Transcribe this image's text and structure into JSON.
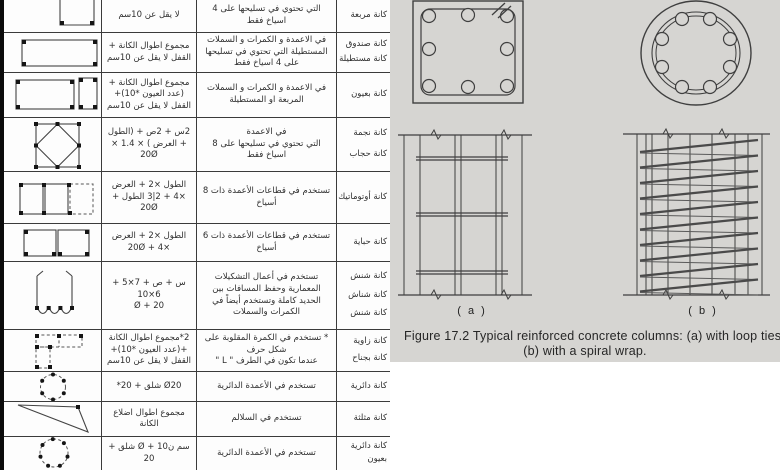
{
  "colors": {
    "figure_panel_bg": "#d6d5d2",
    "drawing_line": "#3f3f3f",
    "table_line": "#3b3b3b"
  },
  "table": {
    "rows": [
      {
        "name_lines": [
          "كانة مربعة"
        ],
        "usage": "التي تحتوي في تسليحها على 4 اسياخ فقط",
        "formula": "لا يقل عن 10سم",
        "shape_icon": "square-stirrup-icon"
      },
      {
        "name_lines": [
          "كانة صندوق",
          "كانة مستطيلة"
        ],
        "usage": "في الاعمدة و الكمرات و السملات المستطيلة التي تحتوي في تسليحها على 4 اسياخ فقط",
        "formula": "مجموع اطوال الكانة + القفل لا يقل عن 10سم",
        "shape_icon": "rect-stirrup-icon"
      },
      {
        "name_lines": [
          "كانة بعيون"
        ],
        "usage": "في الاعمدة و الكمرات و السملات المربعة او المستطيلة",
        "formula": "مجموع اطوال الكانة +(عدد العيون *10)+ القفل لا يقل عن 10سم",
        "shape_icon": "eyed-stirrup-icon"
      },
      {
        "name_lines": [
          "كانة نجمة",
          "كانة حجاب"
        ],
        "usage": "في الاعمدة\nالتي تحتوي في تسليحها على 8 اسياخ فقط",
        "formula": "2س + 2ص + (الطول + العرض ) × 1.4 × 20Ø",
        "shape_icon": "star-stirrup-icon"
      },
      {
        "name_lines": [
          "كانة أوتوماتيك"
        ],
        "usage": "تستخدم في قطاعات الأعمدة ذات 8 أسياخ",
        "formula": "الطول ×2 + العرض ×4 + 2|3 الطول + 20Ø",
        "shape_icon": "automatic-stirrup-icon"
      },
      {
        "name_lines": [
          "كانة حباية"
        ],
        "usage": "تستخدم في قطاعات الأعمدة ذات 6 أسياخ",
        "formula": "الطول ×2 + العرض ×4 + 20Ø",
        "shape_icon": "hbaya-stirrup-icon"
      },
      {
        "name_lines": [
          "كانة شنش",
          "كانة شناش",
          "كانة شنش"
        ],
        "usage": "تستخدم في أعمال التشكيلات المعمارية وحفظ المسافات بين الحديد كاملة وتستخدم أيضاً في الكمرات والسملات",
        "formula": "س + ص + 7×5 + 6×10\n20 + Ø",
        "shape_icon": "shenesh-stirrup-icon"
      },
      {
        "name_lines": [
          "كانة زاوية",
          "كانة بجناح"
        ],
        "usage": "* تستخدم في الكمرة المقلوبة على شكل حرف\nعندما تكون في الطرف \" L \"",
        "formula": "2*مجموع اطوال الكانة +(عدد العيون *10)+ القفل لا يقل عن 10سم",
        "shape_icon": "circular-ties-stirrup-icon-angle"
      },
      {
        "name_lines": [
          "كانة دائرية"
        ],
        "usage": "تستخدم في الأعمدة الدائرية",
        "formula": "Ø20 شلق + 20*",
        "shape_icon": "circular-stirrup-icon"
      },
      {
        "name_lines": [
          "كانة مثلثة"
        ],
        "usage": "تستخدم في السلالم",
        "formula": "مجموع اطوال اضلاع الكانة",
        "shape_icon": "triangular-stirrup-icon"
      },
      {
        "name_lines": [
          "كانة دائرية",
          "بعيون"
        ],
        "usage": "تستخدم في الأعمدة الدائرية",
        "formula": "سم ن10 + Ø شلق + 20",
        "shape_icon": "circular-eyed-stirrup-icon"
      }
    ]
  },
  "figure": {
    "label_a": "( a )",
    "label_b": "( b )",
    "caption_line1": "Figure 17.2 Typical reinforced concrete columns: (a) with loop ties",
    "caption_line2": "(b) with a spiral wrap."
  }
}
